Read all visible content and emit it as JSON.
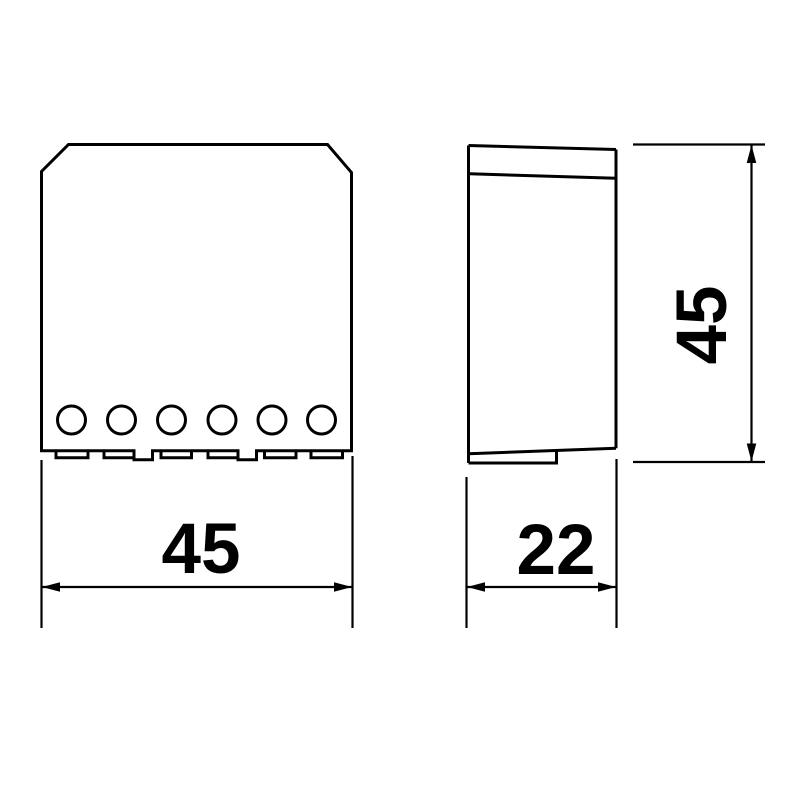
{
  "canvas": {
    "background": "#ffffff",
    "line_color": "#000000",
    "text_color": "#000000"
  },
  "drawing": {
    "description": "Two-view technical dimension drawing of a flush-mount electronic module",
    "front_view": {
      "name": "front-view",
      "terminal_holes": 6,
      "terminal_tabs": 6,
      "bottom_notches": 2
    },
    "side_view": {
      "name": "side-view"
    },
    "dimensions": {
      "front_width": "45",
      "side_depth": "22",
      "side_height": "45"
    }
  }
}
